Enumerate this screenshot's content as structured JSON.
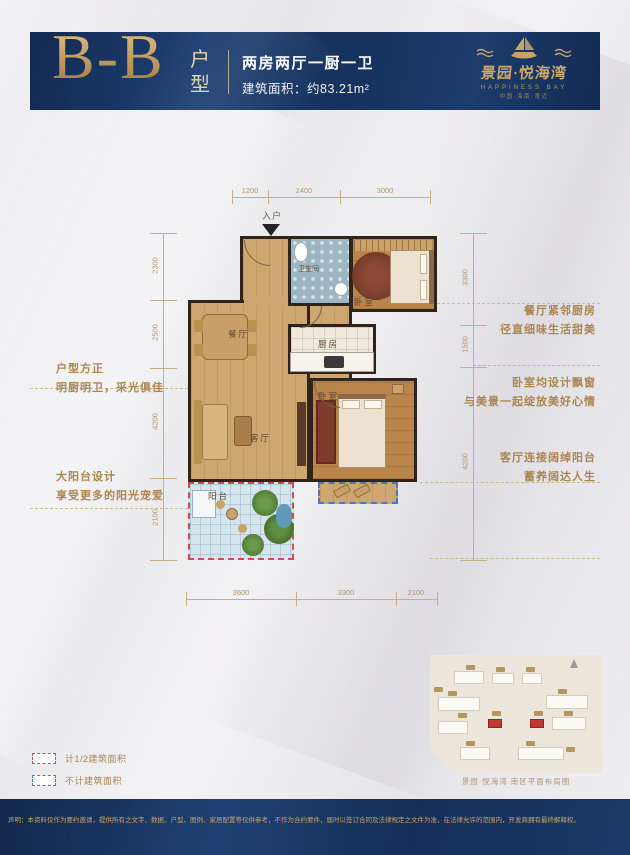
{
  "header": {
    "unit_code": "B-B",
    "unit_label": "户型",
    "spec": "两房两厅一厨一卫",
    "area": "建筑面积：约83.21m²",
    "brand": {
      "name": "景园·悦海湾",
      "en": "HAPPINESS BAY",
      "region": "中国·海南·澄迈"
    }
  },
  "plan": {
    "entry": "入户",
    "rooms": {
      "dining": "餐厅",
      "living": "客厅",
      "kitchen": "厨房",
      "bath": "卫生间",
      "bedroom1": "卧室",
      "bedroom2": "卧室",
      "balcony": "阳台"
    },
    "dims": {
      "top": [
        "1200",
        "2400",
        "3000"
      ],
      "bottom": [
        "3600",
        "3300",
        "2100"
      ],
      "left": [
        "2300",
        "2500",
        "4200",
        "2100"
      ],
      "right": [
        "3300",
        "1500",
        "4200"
      ]
    }
  },
  "annotations": {
    "left": [
      [
        "户型方正",
        "明厨明卫，采光俱佳"
      ],
      [
        "大阳台设计",
        "享受更多的阳光宠爱"
      ]
    ],
    "right": [
      [
        "餐厅紧邻厨房",
        "径直细味生活甜美"
      ],
      [
        "卧室均设计飘窗",
        "与美景一起绽放美好心情"
      ],
      [
        "客厅连接阔绰阳台",
        "蓄养阔达人生"
      ]
    ]
  },
  "legend": [
    {
      "label": "计1/2建筑面积"
    },
    {
      "label": "不计建筑面积"
    }
  ],
  "siteplan": {
    "caption": "景园·悦海湾 南区平面布局图"
  },
  "footer": {
    "disclaimer": "声明：本资料仅作为要约邀请，提供所有之文字、数据、户型、图例、家居配置等仅供参考，不作为合约要件，届时以签订合同及法律规定之文件为准，在法律允许的范围内，开发商拥有最终解释权。"
  },
  "colors": {
    "navy": "#16325d",
    "gold": "#c9a266",
    "annotation_tan": "#ab864f",
    "half_area_dash": "#cc4a4a",
    "excluded_dash": "#4a79b8"
  }
}
